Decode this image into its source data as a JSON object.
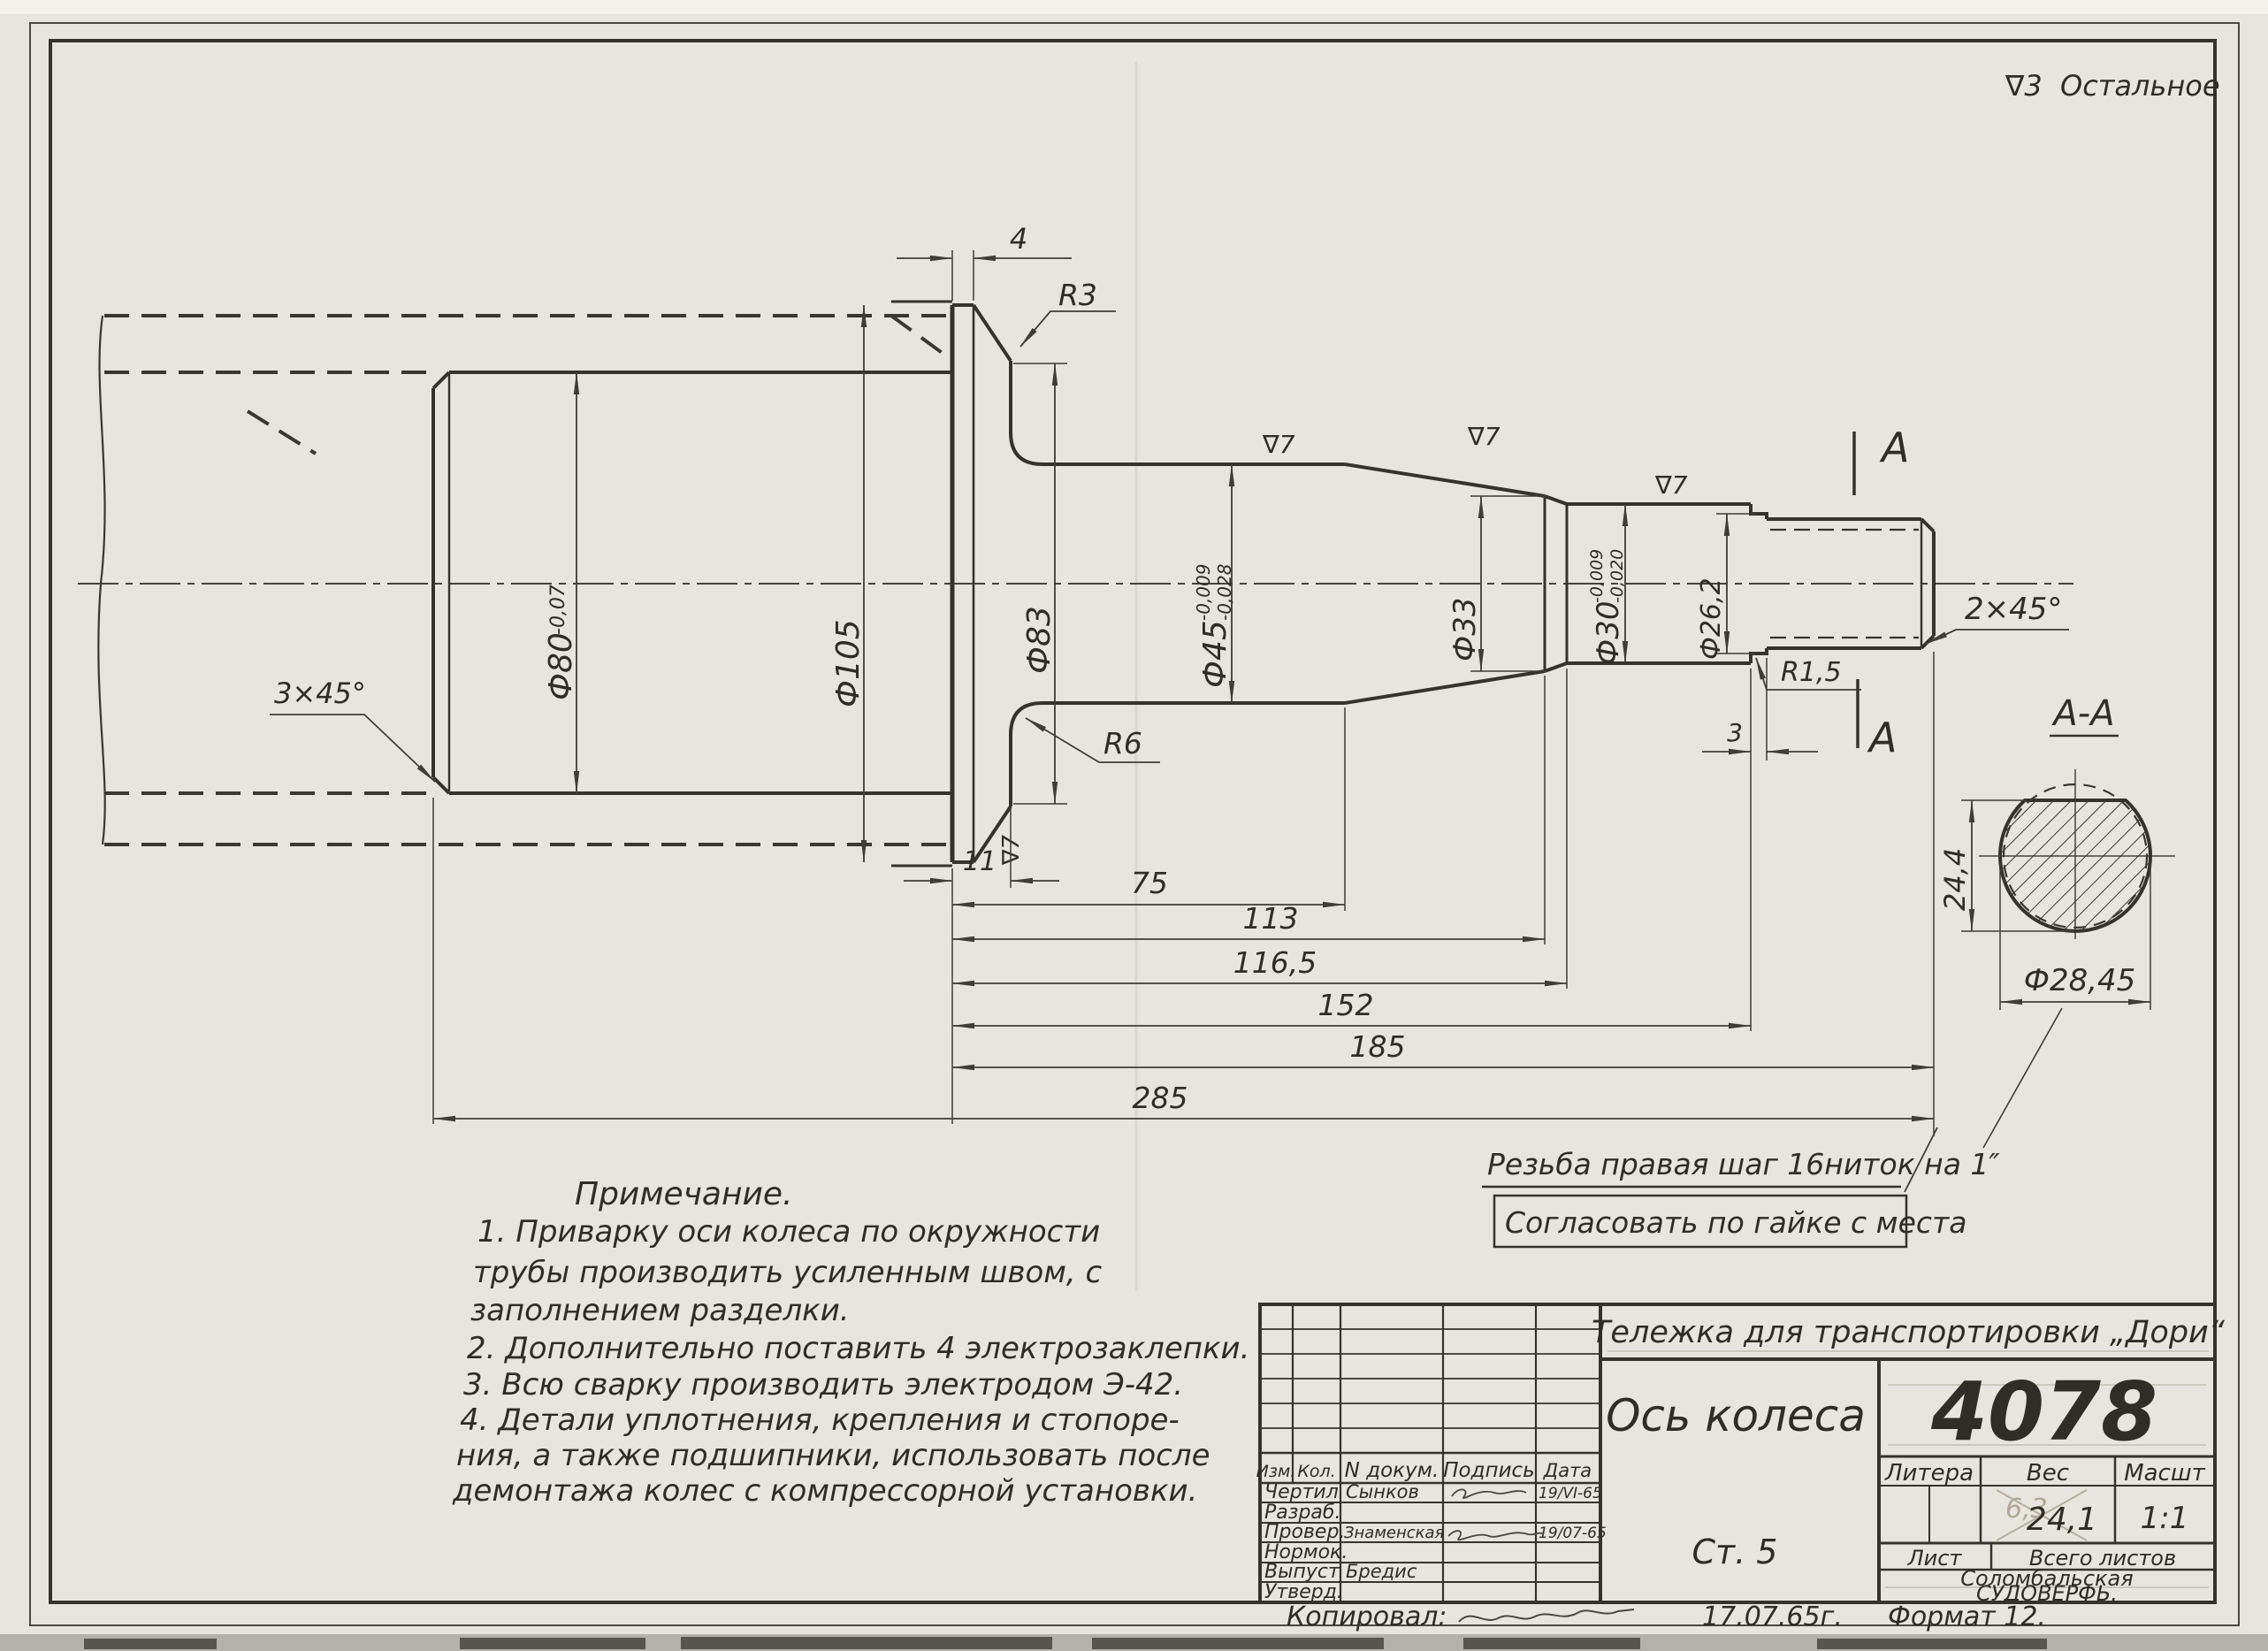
{
  "sheet": {
    "surface_note_symbol": "∇3",
    "surface_note": "Остальное"
  },
  "dims": {
    "chamfer_left": "3×45°",
    "d80": "Ф80",
    "d80_tol": "-0,07",
    "d105": "Ф105",
    "d83": "Ф83",
    "land": "4",
    "r3": "R3",
    "r6": "R6",
    "finish": "∇7",
    "d45": "Ф45",
    "d45_tol_u": "-0,009",
    "d45_tol_l": "-0,028",
    "d33": "Ф33",
    "d30": "Ф30",
    "d30_tol_u": "-0,009",
    "d30_tol_l": "-0,020",
    "d26": "Ф26,2",
    "chamfer_right": "2×45°",
    "r15": "R1,5",
    "groove_w": "3",
    "len11": "11",
    "len75": "75",
    "len113": "113",
    "len116": "116,5",
    "len152": "152",
    "len185": "185",
    "len285": "285",
    "section_mark": "A",
    "section_title": "A-A",
    "flat_height": "24,4",
    "thread_d": "Ф28,45"
  },
  "thread_note": {
    "line1": "Резьба правая шаг 16ниток на 1″",
    "line2": "Согласовать по гайке с места"
  },
  "notes": {
    "title": "Примечание.",
    "lines": [
      "1. Приварку оси колеса по окружности",
      "трубы производить усиленным швом, с",
      "заполнением разделки.",
      "2. Дополнительно поставить 4 электрозаклепки.",
      "3. Всю сварку производить электродом Э-42.",
      "4. Детали уплотнения, крепления и стопоре-",
      "ния, а также подшипники, использовать после",
      "демонтажа колес с компрессорной установки."
    ]
  },
  "title_block": {
    "project": "Тележка для транспортировки „Дори“",
    "part_title": "Ось колеса",
    "drawing_number": "4078",
    "material": "Ст. 5",
    "litera_label": "Литера",
    "weight_label": "Вес",
    "scale_label": "Масшт",
    "weight_value": "24,1",
    "weight_crossed": "6,3",
    "scale_value": "1:1",
    "sheet_label": "Лист",
    "total_sheets_label": "Всего листов",
    "org_line1": "Соломбальская",
    "org_line2": "СУДОВЕРФЬ.",
    "columns": [
      "Изм.",
      "Кол.",
      "N докум.",
      "Подпись",
      "Дата"
    ],
    "rows": [
      {
        "role": "Чертил",
        "name": "Сынков",
        "date": "19/VI-65"
      },
      {
        "role": "Разраб.",
        "name": "",
        "date": ""
      },
      {
        "role": "Провер.",
        "name": "Знаменская",
        "date": "19/07-65"
      },
      {
        "role": "Нормок.",
        "name": "",
        "date": ""
      },
      {
        "role": "Выпуст",
        "name": "Бредис",
        "date": ""
      },
      {
        "role": "Утверд.",
        "name": "",
        "date": ""
      }
    ],
    "footer": {
      "copied": "Копировал:",
      "date": "17.07.65г.",
      "format": "Формат 12."
    }
  }
}
